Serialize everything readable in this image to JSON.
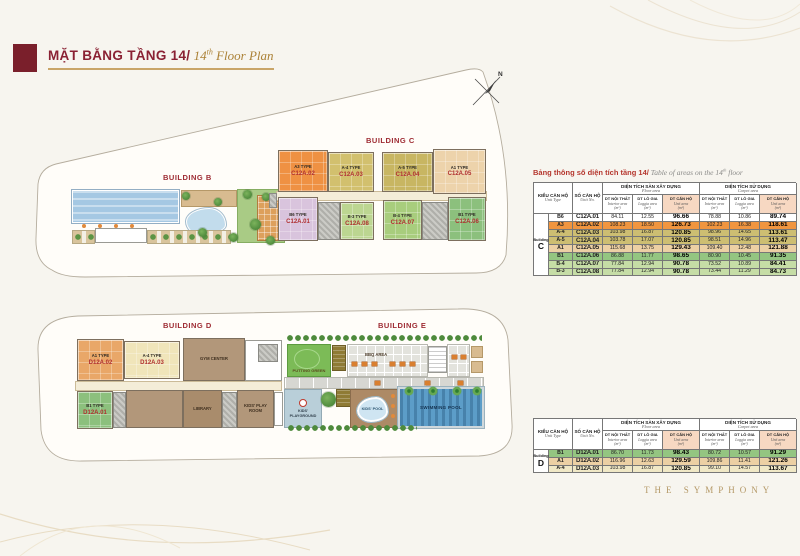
{
  "header": {
    "accent_color": "#7a1f2b",
    "title_vi": "MẶT BẰNG TẦNG 14/",
    "title_en_prefix": " 14",
    "title_en_sup": "th",
    "title_en_suffix": " Floor Plan"
  },
  "compass": {
    "north_label": "N"
  },
  "plan_top": {
    "building_b_label": "BUILDING B",
    "building_c_label": "BUILDING C",
    "units": {
      "c01": {
        "type": "B6 TYPE",
        "no": "C12A.01"
      },
      "c02": {
        "type": "A3 TYPE",
        "no": "C12A.02"
      },
      "c03": {
        "type": "A-4 TYPE",
        "no": "C12A.03"
      },
      "c04": {
        "type": "A-5 TYPE",
        "no": "C12A.04"
      },
      "c05": {
        "type": "A1 TYPE",
        "no": "C12A.05"
      },
      "c06": {
        "type": "B1 TYPE",
        "no": "C12A.06"
      },
      "c07": {
        "type": "B-4 TYPE",
        "no": "C12A.07"
      },
      "c08": {
        "type": "B-3 TYPE",
        "no": "C12A.08"
      }
    }
  },
  "plan_bottom": {
    "building_d_label": "BUILDING D",
    "building_e_label": "BUILDING E",
    "units": {
      "d01": {
        "type": "B1 TYPE",
        "no": "D12A.01"
      },
      "d02": {
        "type": "A1 TYPE",
        "no": "D12A.02"
      },
      "d03": {
        "type": "A-4 TYPE",
        "no": "D12A.03"
      }
    },
    "amenities": {
      "gym": "GYM CENTER",
      "library": "LIBRARY",
      "kids_room": "KIDS' PLAY ROOM",
      "putting_green": "PUTTING GREEN",
      "bbq": "BBQ AREA",
      "kids_playground": "KIDS' PLAYGROUND",
      "kids_pool": "KIDS' POOL",
      "swimming_pool": "SWIMMING POOL"
    }
  },
  "area_table": {
    "caption_vi": "Bảng thông số diện tích tầng 14/",
    "caption_en_prefix": " Table of areas on the 14",
    "caption_en_sup": "th",
    "caption_en_suffix": " floor",
    "headers": {
      "unit_type_vi": "KIỂU CĂN HỘ",
      "unit_type_en": "Unit Type",
      "unit_no_vi": "SỐ CĂN HỘ",
      "unit_no_en": "Unit No.",
      "floor_vi": "DIỆN TÍCH SÀN XÂY DỰNG",
      "floor_en": "Floor area",
      "use_vi": "DIỆN TÍCH SỬ DỤNG",
      "use_en": "Carpet area",
      "interior_vi": "DT NỘI THẤT",
      "interior_en": "Interior area",
      "loggia_vi": "DT LÔ GIA",
      "loggia_en": "Loggia area",
      "unit_vi": "DT CĂN HỘ",
      "unit_en": "Unit area",
      "sqm": "(m²)",
      "highlight_color": "#f7d8c2"
    },
    "building_word": "Building",
    "tables": {
      "c": {
        "letter": "C",
        "rows": [
          {
            "type": "B6",
            "no": "C12A.01",
            "v": [
              "84.11",
              "12.55",
              "96.66",
              "78.88",
              "10.86",
              "89.74"
            ],
            "color": "#ffffff"
          },
          {
            "type": "A3",
            "no": "C12A.02",
            "v": [
              "108.23",
              "18.50",
              "126.73",
              "102.23",
              "16.38",
              "118.61"
            ],
            "color": "#f0953f"
          },
          {
            "type": "A-4",
            "no": "C12A.03",
            "v": [
              "103.98",
              "16.87",
              "120.85",
              "98.96",
              "14.65",
              "113.61"
            ],
            "color": "#cdbe72"
          },
          {
            "type": "A-5",
            "no": "C12A.04",
            "v": [
              "103.78",
              "17.07",
              "120.85",
              "98.51",
              "14.96",
              "113.47"
            ],
            "color": "#cdbe72"
          },
          {
            "type": "A1",
            "no": "C12A.05",
            "v": [
              "115.68",
              "13.75",
              "129.43",
              "109.40",
              "12.48",
              "121.88"
            ],
            "color": "#ecd0a4"
          },
          {
            "type": "B1",
            "no": "C12A.06",
            "v": [
              "86.88",
              "11.77",
              "98.65",
              "80.90",
              "10.45",
              "91.35"
            ],
            "color": "#94c581"
          },
          {
            "type": "B-4",
            "no": "C12A.07",
            "v": [
              "77.84",
              "12.94",
              "90.78",
              "73.52",
              "10.89",
              "84.41"
            ],
            "color": "#c6dda6"
          },
          {
            "type": "B-3",
            "no": "C12A.08",
            "v": [
              "77.84",
              "12.94",
              "90.78",
              "73.44",
              "11.29",
              "84.73"
            ],
            "color": "#c6dda6"
          }
        ]
      },
      "d": {
        "letter": "D",
        "rows": [
          {
            "type": "B1",
            "no": "D12A.01",
            "v": [
              "86.70",
              "11.73",
              "98.43",
              "80.72",
              "10.57",
              "91.29"
            ],
            "color": "#94c581"
          },
          {
            "type": "A1",
            "no": "D12A.02",
            "v": [
              "116.96",
              "12.63",
              "129.59",
              "109.86",
              "11.41",
              "121.26"
            ],
            "color": "#ecd0a4"
          },
          {
            "type": "A-4",
            "no": "D12A.03",
            "v": [
              "103.98",
              "16.87",
              "120.85",
              "99.10",
              "14.57",
              "113.67"
            ],
            "color": "#f0e8c6"
          }
        ]
      }
    }
  },
  "footer": {
    "logo": "THE SYMPHONY",
    "logo_color": "#b49866"
  }
}
